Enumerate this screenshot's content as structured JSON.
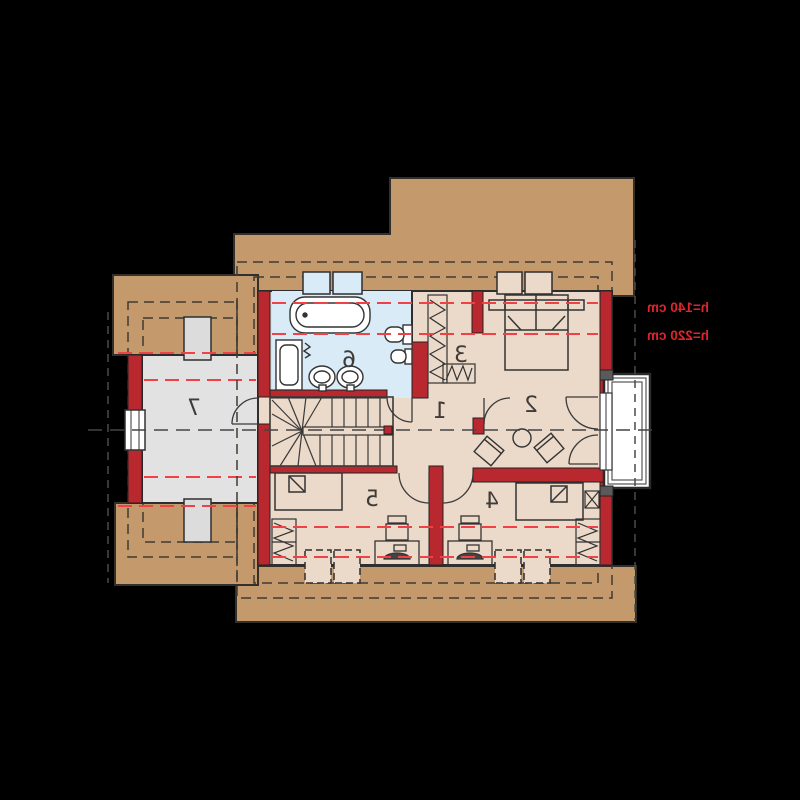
{
  "plan": {
    "kind": "attic floor plan (mirrored print)",
    "rooms": [
      {
        "number": "1"
      },
      {
        "number": "2"
      },
      {
        "number": "3"
      },
      {
        "number": "4"
      },
      {
        "number": "5"
      },
      {
        "number": "6"
      },
      {
        "number": "7"
      }
    ],
    "annotations": {
      "height_line_upper": "h=140 cm",
      "height_line_lower": "h=220 cm"
    },
    "colors": {
      "background": "#000000",
      "roof_tan": "#c49a6c",
      "wall_red": "#b8282e",
      "floor_beige": "#ebd9c9",
      "bathroom_blue": "#d8ebf7",
      "room7_gray": "#e2e2e2",
      "height_dash_red": "#ef4146",
      "annotation_red": "#e0242b",
      "line_dark": "#333333",
      "fixture_white": "#ffffff",
      "chimney_gray": "#dcdcdc"
    }
  }
}
